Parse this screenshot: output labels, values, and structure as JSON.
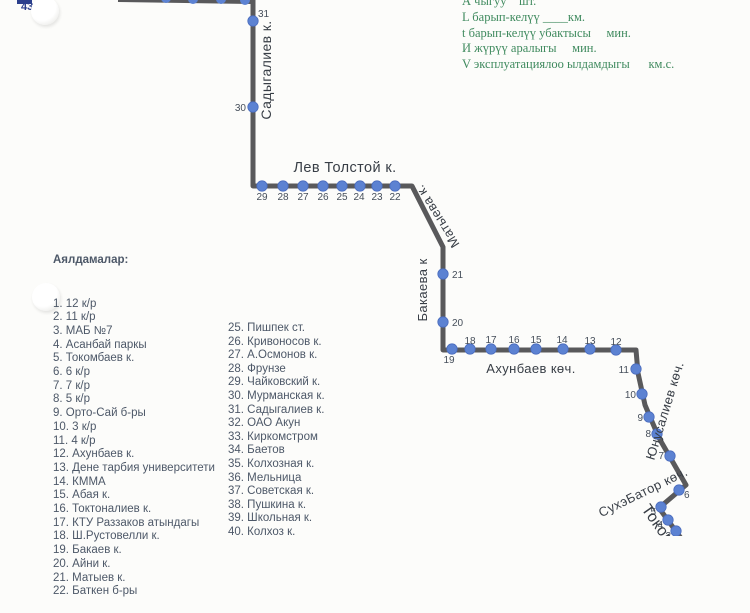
{
  "corner_mark": {
    "route_number": "431"
  },
  "legend": {
    "color": "#3f8a5e",
    "lines": [
      "А чыгуу    шт.",
      "L барып-келүү ____км.",
      "t барып-келүү убактысы     мин.",
      "И жүрүү аралыгы     мин.",
      "V эксплуатациялоо ылдамдыгы      км.с."
    ]
  },
  "stops_list": {
    "title": "Аялдамалар:",
    "left": [
      "1. 12 к/р",
      "2. 11 к/р",
      "3. МАБ №7",
      "4. Асанбай паркы",
      "5. Токомбаев к.",
      "6. 6 к/р",
      "7. 7 к/р",
      "8. 5 к/р",
      "9. Орто-Сай б-ры",
      "10. 3 к/р",
      "11. 4 к/р",
      "12. Ахунбаев к.",
      "13. Дене тарбия университети",
      "14. КММА",
      "15. Абая к.",
      "16. Токтоналиев к.",
      "17. КТУ Раззаков атындагы",
      "18. Ш.Рустовелли к.",
      "19. Бакаев к.",
      "20. Айни к.",
      "21. Матыев к.",
      "22. Баткен б-ры"
    ],
    "right": [
      "25. Пишпек ст.",
      "26. Кривоносов к.",
      "27. А.Осмонов к.",
      "28. Фрунзе",
      "29. Чайковский к.",
      "30. Мурманская к.",
      "31. Садыгалиев к.",
      "32. ОАО Акун",
      "33. Киркомстром",
      "34. Баетов",
      "35. Колхозная к.",
      "36. Мельница",
      "37. Советская к.",
      "38. Пушкина к.",
      "39. Школьная к.",
      "40. Колхоз к."
    ]
  },
  "route": {
    "line_color": "#59595b",
    "dot_color": "#5c82d2",
    "dot_stroke": "#4a6cbe",
    "number_color": "#454e5a",
    "street_color": "#383e46",
    "path_points": [
      [
        253,
        -6
      ],
      [
        253,
        186
      ],
      [
        412,
        186
      ],
      [
        443,
        247
      ],
      [
        443,
        350
      ],
      [
        636,
        350
      ],
      [
        638,
        373
      ],
      [
        645,
        405
      ],
      [
        659,
        438
      ],
      [
        686,
        485
      ],
      [
        659,
        508
      ],
      [
        683,
        541
      ]
    ],
    "top_segment": [
      [
        118,
        0
      ],
      [
        251,
        2
      ]
    ],
    "top_dots": [
      [
        166,
        -2
      ],
      [
        193,
        -1
      ],
      [
        221,
        -1
      ],
      [
        245,
        0
      ]
    ],
    "stops": [
      {
        "num": "31",
        "x": 253,
        "y": 21,
        "lx": 258,
        "ly": 17,
        "anchor": "start"
      },
      {
        "num": "30",
        "x": 253,
        "y": 107,
        "lx": 246,
        "ly": 111,
        "anchor": "end"
      },
      {
        "num": "29",
        "x": 262,
        "y": 186,
        "lx": 262,
        "ly": 200,
        "anchor": "middle"
      },
      {
        "num": "28",
        "x": 283,
        "y": 186,
        "lx": 283,
        "ly": 200,
        "anchor": "middle"
      },
      {
        "num": "27",
        "x": 303,
        "y": 186,
        "lx": 303,
        "ly": 200,
        "anchor": "middle"
      },
      {
        "num": "26",
        "x": 323,
        "y": 186,
        "lx": 323,
        "ly": 200,
        "anchor": "middle"
      },
      {
        "num": "25",
        "x": 342,
        "y": 186,
        "lx": 342,
        "ly": 200,
        "anchor": "middle"
      },
      {
        "num": "24",
        "x": 360,
        "y": 186,
        "lx": 359,
        "ly": 200,
        "anchor": "middle"
      },
      {
        "num": "23",
        "x": 377,
        "y": 186,
        "lx": 377,
        "ly": 200,
        "anchor": "middle"
      },
      {
        "num": "22",
        "x": 395,
        "y": 186,
        "lx": 395,
        "ly": 200,
        "anchor": "middle"
      },
      {
        "num": "21",
        "x": 443,
        "y": 274,
        "lx": 452,
        "ly": 278,
        "anchor": "start"
      },
      {
        "num": "20",
        "x": 443,
        "y": 322,
        "lx": 452,
        "ly": 326,
        "anchor": "start"
      },
      {
        "num": "19",
        "x": 452,
        "y": 349,
        "lx": 449,
        "ly": 363,
        "anchor": "middle"
      },
      {
        "num": "18",
        "x": 470,
        "y": 349,
        "lx": 470,
        "ly": 344,
        "anchor": "middle"
      },
      {
        "num": "17",
        "x": 491,
        "y": 349,
        "lx": 491,
        "ly": 343,
        "anchor": "middle"
      },
      {
        "num": "16",
        "x": 514,
        "y": 349,
        "lx": 514,
        "ly": 343,
        "anchor": "middle"
      },
      {
        "num": "15",
        "x": 536,
        "y": 349,
        "lx": 536,
        "ly": 343,
        "anchor": "middle"
      },
      {
        "num": "14",
        "x": 563,
        "y": 349,
        "lx": 562,
        "ly": 343,
        "anchor": "middle"
      },
      {
        "num": "13",
        "x": 590,
        "y": 349,
        "lx": 590,
        "ly": 344,
        "anchor": "middle"
      },
      {
        "num": "12",
        "x": 616,
        "y": 350,
        "lx": 616,
        "ly": 345,
        "anchor": "middle"
      },
      {
        "num": "11",
        "x": 636,
        "y": 369,
        "lx": 629,
        "ly": 373,
        "anchor": "end"
      },
      {
        "num": "10",
        "x": 642,
        "y": 394,
        "lx": 636,
        "ly": 398,
        "anchor": "end"
      },
      {
        "num": "9",
        "x": 649,
        "y": 417,
        "lx": 643,
        "ly": 421,
        "anchor": "end"
      },
      {
        "num": "8",
        "x": 657,
        "y": 434,
        "lx": 651,
        "ly": 437,
        "anchor": "end"
      },
      {
        "num": "7",
        "x": 670,
        "y": 456,
        "lx": 664,
        "ly": 459,
        "anchor": "end"
      },
      {
        "num": "6",
        "x": 679,
        "y": 490,
        "lx": 684,
        "ly": 498,
        "anchor": "start"
      },
      {
        "num": "5",
        "x": 661,
        "y": 507,
        "lx": 656,
        "ly": 515,
        "anchor": "end"
      },
      {
        "num": "4",
        "x": 668,
        "y": 520,
        "lx": 663,
        "ly": 528,
        "anchor": "end"
      },
      {
        "num": "3",
        "x": 676,
        "y": 531,
        "lx": 671,
        "ly": 539,
        "anchor": "end"
      }
    ],
    "streets": [
      {
        "name": "Садыгалиев к.",
        "x": 271,
        "y": 70,
        "rotate": -90,
        "size": 14,
        "anchor": "middle"
      },
      {
        "name": "Лев Толстой к.",
        "x": 345,
        "y": 172,
        "rotate": 0,
        "size": 14.5,
        "anchor": "middle"
      },
      {
        "name": "Матыева к.",
        "x": 441,
        "y": 214,
        "rotate": -122,
        "size": 13,
        "anchor": "middle"
      },
      {
        "name": "Бакаева к",
        "x": 427,
        "y": 290,
        "rotate": -90,
        "size": 13,
        "anchor": "middle"
      },
      {
        "name": "Ахунбаев көч.",
        "x": 531,
        "y": 373,
        "rotate": 0,
        "size": 13,
        "anchor": "middle"
      },
      {
        "name": "Юнусалиев көч.",
        "x": 669,
        "y": 412,
        "rotate": -73,
        "size": 13,
        "anchor": "middle"
      },
      {
        "name": "СухэБатор көч.",
        "x": 645,
        "y": 496,
        "rotate": -26,
        "size": 13,
        "anchor": "middle"
      },
      {
        "name": "Токомбаев",
        "x": 641,
        "y": 509,
        "rotate": 55,
        "size": 16,
        "anchor": "start"
      }
    ]
  }
}
